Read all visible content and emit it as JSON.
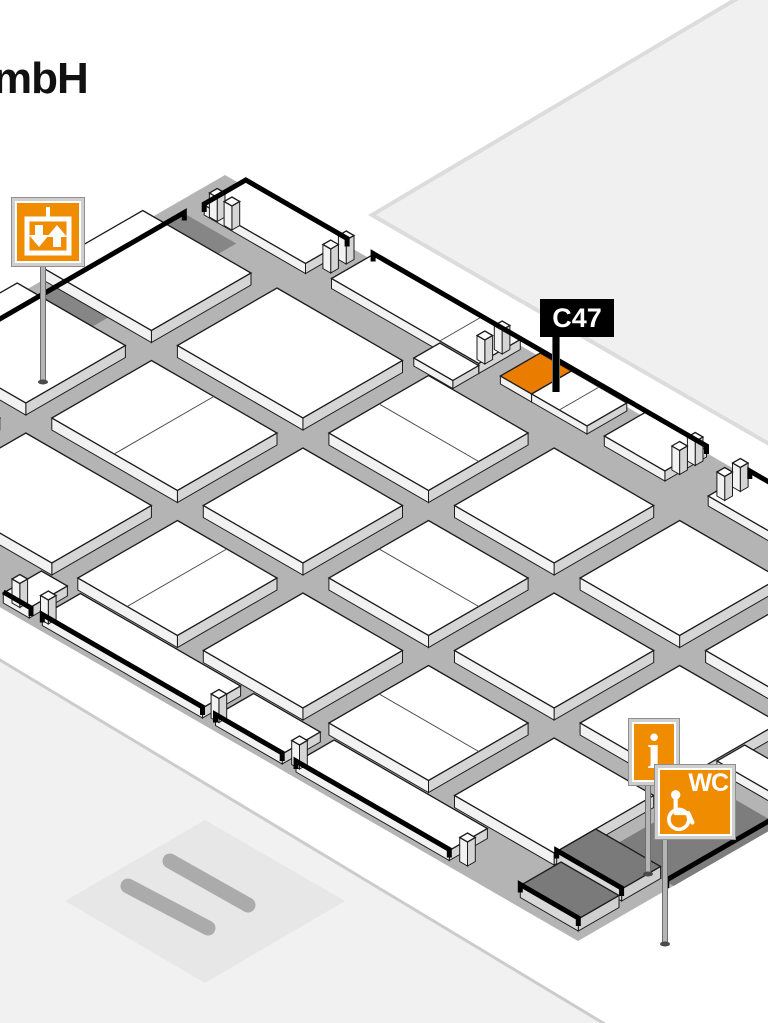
{
  "page": {
    "title_fragment": "mbH"
  },
  "map_data": {
    "flag": {
      "label": "C47",
      "booth_id": "C47"
    },
    "signs": {
      "info_label": "i",
      "wc_label": "WC"
    },
    "colors": {
      "bg": "#ffffff",
      "hall_floor": "#b4b4b4",
      "booth_top": "#ffffff",
      "booth_side_sw": "#f2f2f2",
      "booth_side_se": "#d5d5d5",
      "booth_outline": "#1c1c1c",
      "divider": "#4a4a4a",
      "wall": "#000000",
      "platform_dark": "#868686",
      "wc_platform": "#7d7d7d",
      "dark_slab_top": "#7a7a7a",
      "dark_slab_side": "#d9d9d9",
      "orange_booth": "#ea7d00",
      "sign_orange": "#f08c00",
      "sign_frame": "#cfcfcf",
      "pole": "#b5b5b5",
      "neighbor_fill": "#f0f0f0",
      "neighbor_border": "#dcdcdc",
      "bl_fill": "#f1f1f1",
      "bl_border": "#cccccc",
      "bl_inner": "#e7e7e7",
      "bl_strip": "#ababab",
      "flag_bg": "#000000",
      "flag_text": "#ffffff",
      "title_text": "#111111"
    },
    "iso": {
      "ox": 225,
      "oy": 175,
      "cos": 0.866,
      "sin": 0.5
    },
    "hall_floor_pts": [
      [
        225,
        175
      ],
      [
        1065,
        660
      ],
      [
        578,
        941
      ],
      [
        -262,
        456
      ]
    ],
    "adjacent_hall_tr": {
      "pts": [
        [
          372,
          215
        ],
        [
          748,
          -8
        ],
        [
          790,
          -8
        ],
        [
          790,
          456
        ]
      ]
    },
    "adjacent_area_bl": {
      "outer": [
        [
          -30,
          642
        ],
        [
          618,
          1032
        ],
        [
          -30,
          1032
        ]
      ],
      "inner": [
        [
          205,
          820
        ],
        [
          345,
          901
        ],
        [
          205,
          983
        ],
        [
          65,
          901
        ]
      ],
      "strips": [
        [
          128,
          886,
          208,
          928
        ],
        [
          170,
          861,
          248,
          905
        ]
      ]
    },
    "platforms": [
      {
        "r": [
          15,
          62,
          75,
          345
        ],
        "c": "#868686",
        "name": "elevator-platform"
      },
      {
        "r": [
          895,
          330,
          970,
          452
        ],
        "c": "#7d7d7d",
        "name": "wc-platform"
      }
    ],
    "booths": [
      {
        "r": [
          28,
          4,
          145,
          52
        ],
        "h": 10
      },
      {
        "r": [
          175,
          4,
          345,
          52
        ],
        "h": 10,
        "div": [
          [
            "u",
            300
          ]
        ]
      },
      {
        "r": [
          300,
          52,
          345,
          82
        ],
        "h": 8
      },
      {
        "r": [
          368,
          4,
          404,
          50
        ],
        "h": 8,
        "type": "orange",
        "name": "booth-c47"
      },
      {
        "r": [
          404,
          4,
          468,
          50
        ],
        "h": 8,
        "div": [
          [
            "u",
            436
          ]
        ]
      },
      {
        "r": [
          490,
          4,
          560,
          52
        ],
        "h": 10
      },
      {
        "r": [
          610,
          4,
          970,
          52
        ],
        "h": 10
      },
      {
        "r": [
          0,
          95,
          125,
          210
        ],
        "h": 12
      },
      {
        "r": [
          155,
          95,
          300,
          210
        ],
        "h": 12
      },
      {
        "r": [
          330,
          95,
          445,
          210
        ],
        "h": 12,
        "div": [
          [
            "v",
            152
          ]
        ]
      },
      {
        "r": [
          475,
          95,
          590,
          210
        ],
        "h": 12
      },
      {
        "r": [
          620,
          95,
          735,
          210
        ],
        "h": 12
      },
      {
        "r": [
          765,
          95,
          880,
          210
        ],
        "h": 12
      },
      {
        "r": [
          0,
          240,
          125,
          355
        ],
        "h": 12
      },
      {
        "r": [
          155,
          240,
          300,
          355
        ],
        "h": 12,
        "div": [
          [
            "u",
            227
          ]
        ]
      },
      {
        "r": [
          330,
          240,
          445,
          355
        ],
        "h": 12
      },
      {
        "r": [
          475,
          240,
          590,
          355
        ],
        "h": 12,
        "div": [
          [
            "v",
            297
          ]
        ]
      },
      {
        "r": [
          620,
          240,
          735,
          355
        ],
        "h": 12
      },
      {
        "r": [
          765,
          240,
          880,
          355
        ],
        "h": 12
      },
      {
        "r": [
          0,
          385,
          125,
          500
        ],
        "h": 12
      },
      {
        "r": [
          155,
          385,
          300,
          500
        ],
        "h": 12
      },
      {
        "r": [
          330,
          385,
          445,
          500
        ],
        "h": 12,
        "div": [
          [
            "u",
            387
          ]
        ]
      },
      {
        "r": [
          475,
          385,
          590,
          500
        ],
        "h": 12
      },
      {
        "r": [
          620,
          385,
          735,
          500
        ],
        "h": 12,
        "div": [
          [
            "v",
            442
          ]
        ]
      },
      {
        "r": [
          765,
          385,
          880,
          500
        ],
        "h": 12
      },
      {
        "r": [
          300,
          512,
          330,
          556
        ],
        "h": 10
      },
      {
        "r": [
          345,
          512,
          530,
          556
        ],
        "h": 10
      },
      {
        "r": [
          545,
          512,
          622,
          556
        ],
        "h": 10
      },
      {
        "r": [
          638,
          512,
          815,
          556
        ],
        "h": 10
      },
      {
        "r": [
          880,
          280,
          970,
          312
        ],
        "h": 10
      },
      {
        "r": [
          880,
          452,
          955,
          497
        ],
        "h": 12,
        "type": "dark",
        "name": "service-block"
      },
      {
        "r": [
          893,
          505,
          960,
          552
        ],
        "h": 12,
        "type": "dark",
        "name": "service-block"
      }
    ],
    "posts": [
      [
        33,
        42
      ],
      [
        50,
        42
      ],
      [
        150,
        10
      ],
      [
        150,
        28
      ],
      [
        330,
        10
      ],
      [
        330,
        30
      ],
      [
        553,
        10
      ],
      [
        553,
        28
      ],
      [
        605,
        10
      ],
      [
        605,
        28
      ],
      [
        305,
        542
      ],
      [
        338,
        542
      ],
      [
        535,
        542
      ],
      [
        628,
        542
      ],
      [
        822,
        542
      ]
    ],
    "walls": [
      {
        "pts": [
          [
            28,
            52
          ],
          [
            28,
            4
          ],
          [
            145,
            4
          ]
        ],
        "z": 11,
        "t": [
          1,
          1
        ]
      },
      {
        "pts": [
          [
            175,
            4
          ],
          [
            560,
            4
          ]
        ],
        "z": 11,
        "t": [
          1,
          1
        ]
      },
      {
        "pts": [
          [
            610,
            4
          ],
          [
            975,
            4
          ]
        ],
        "z": 11,
        "t": [
          1,
          0
        ]
      },
      {
        "pts": [
          [
            15,
            62
          ],
          [
            15,
            292
          ]
        ],
        "z": 1,
        "t": [
          1,
          0
        ]
      },
      {
        "pts": [
          [
            300,
            556
          ],
          [
            332,
            556
          ]
        ],
        "z": 11,
        "t": [
          0,
          1
        ]
      },
      {
        "pts": [
          [
            345,
            556
          ],
          [
            530,
            556
          ]
        ],
        "z": 11,
        "t": [
          1,
          1
        ]
      },
      {
        "pts": [
          [
            545,
            556
          ],
          [
            622,
            556
          ]
        ],
        "z": 11,
        "t": [
          1,
          1
        ]
      },
      {
        "pts": [
          [
            638,
            556
          ],
          [
            815,
            556
          ]
        ],
        "z": 11,
        "t": [
          1,
          1
        ]
      },
      {
        "pts": [
          [
            962,
            326
          ],
          [
            962,
            452
          ]
        ],
        "z": 2,
        "t": [
          1,
          1
        ]
      },
      {
        "pts": [
          [
            880,
            497
          ],
          [
            955,
            497
          ]
        ],
        "z": 13,
        "t": [
          1,
          1
        ]
      },
      {
        "pts": [
          [
            893,
            552
          ],
          [
            960,
            552
          ]
        ],
        "z": 13,
        "t": [
          1,
          1
        ]
      }
    ],
    "poles": [
      {
        "x1": 43,
        "y1": 264,
        "x2": 43,
        "y2": 382
      },
      {
        "x1": 648,
        "y1": 782,
        "x2": 648,
        "y2": 874
      },
      {
        "x1": 665,
        "y1": 840,
        "x2": 665,
        "y2": 944
      },
      {
        "x1": 556,
        "y1": 326,
        "x2": 556,
        "y2": 392,
        "c": "#000000",
        "w": 6,
        "nofoot": true
      }
    ]
  }
}
